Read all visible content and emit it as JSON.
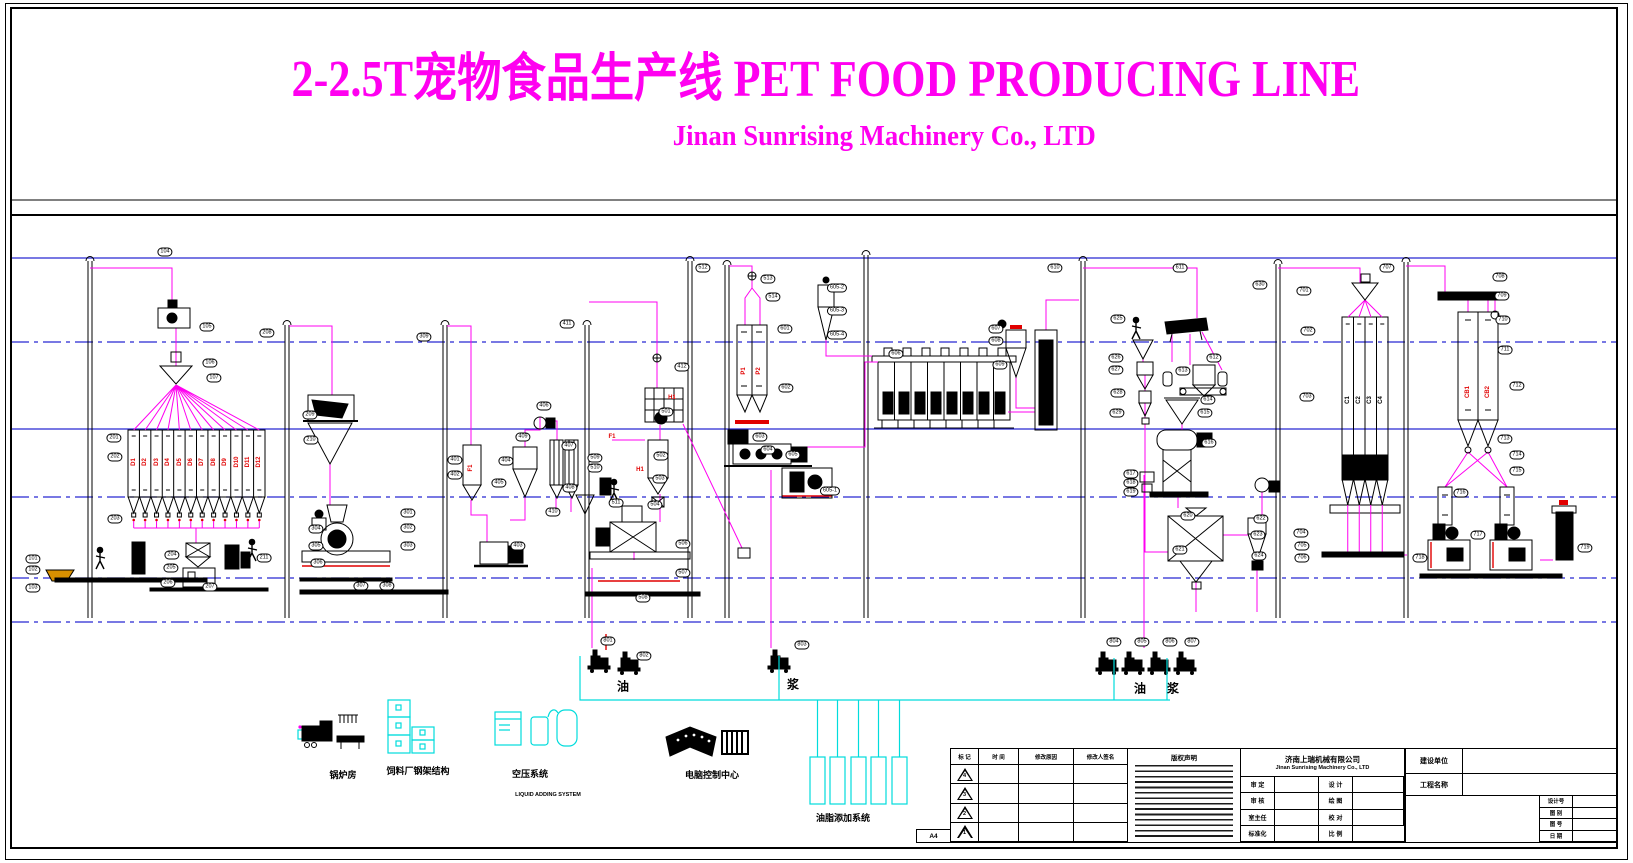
{
  "header": {
    "title": "2-2.5T宠物食品生产线 PET FOOD PRODUCING LINE",
    "subtitle": "Jinan Sunrising Machinery Co., LTD"
  },
  "colors": {
    "magenta": "#FF00F0",
    "blue": "#2828D2",
    "cyan": "#00DCDC",
    "red": "#E10000",
    "black": "#000000"
  },
  "tags": [
    [
      "101",
      33,
      559
    ],
    [
      "102",
      33,
      570
    ],
    [
      "103",
      33,
      588
    ],
    [
      "104",
      165,
      252
    ],
    [
      "105",
      207,
      327
    ],
    [
      "106",
      210,
      363
    ],
    [
      "107",
      214,
      378
    ],
    [
      "201",
      114,
      438
    ],
    [
      "202",
      115,
      457
    ],
    [
      "203",
      115,
      519
    ],
    [
      "204",
      172,
      555
    ],
    [
      "205",
      171,
      568
    ],
    [
      "206",
      168,
      583
    ],
    [
      "207",
      210,
      587
    ],
    [
      "208",
      267,
      333
    ],
    [
      "209",
      310,
      415
    ],
    [
      "210",
      311,
      440
    ],
    [
      "211",
      264,
      558
    ],
    [
      "301",
      408,
      513
    ],
    [
      "302",
      408,
      528
    ],
    [
      "303",
      408,
      546
    ],
    [
      "304",
      316,
      529
    ],
    [
      "305",
      316,
      546
    ],
    [
      "306",
      318,
      563
    ],
    [
      "307",
      361,
      586
    ],
    [
      "308",
      387,
      586
    ],
    [
      "309",
      424,
      337
    ],
    [
      "401",
      455,
      460
    ],
    [
      "402",
      455,
      475
    ],
    [
      "403",
      518,
      546
    ],
    [
      "404",
      506,
      461
    ],
    [
      "405",
      499,
      483
    ],
    [
      "406",
      544,
      406
    ],
    [
      "407",
      569,
      446
    ],
    [
      "408",
      570,
      488
    ],
    [
      "409",
      523,
      437
    ],
    [
      "410",
      553,
      512
    ],
    [
      "411",
      567,
      324
    ],
    [
      "412",
      682,
      367
    ],
    [
      "501",
      666,
      412
    ],
    [
      "502",
      661,
      456
    ],
    [
      "503",
      660,
      479
    ],
    [
      "504",
      655,
      505
    ],
    [
      "506",
      683,
      544
    ],
    [
      "507",
      683,
      573
    ],
    [
      "508",
      643,
      598
    ],
    [
      "509",
      595,
      458
    ],
    [
      "510",
      595,
      468
    ],
    [
      "511",
      616,
      503
    ],
    [
      "512",
      703,
      268
    ],
    [
      "513",
      768,
      279
    ],
    [
      "514",
      773,
      297
    ],
    [
      "601",
      785,
      329
    ],
    [
      "602",
      786,
      388
    ],
    [
      "603",
      760,
      437
    ],
    [
      "604",
      768,
      450
    ],
    [
      "605",
      793,
      455
    ],
    [
      "605-1",
      830,
      491
    ],
    [
      "605-2",
      837,
      288
    ],
    [
      "605-3",
      837,
      311
    ],
    [
      "605-4",
      837,
      335
    ],
    [
      "606",
      896,
      354
    ],
    [
      "607",
      996,
      329
    ],
    [
      "608",
      996,
      341
    ],
    [
      "609",
      1000,
      365
    ],
    [
      "610",
      1055,
      268
    ],
    [
      "611",
      1180,
      268
    ],
    [
      "612",
      1214,
      358
    ],
    [
      "613",
      1183,
      371
    ],
    [
      "614",
      1208,
      400
    ],
    [
      "615",
      1205,
      413
    ],
    [
      "616",
      1209,
      443
    ],
    [
      "617",
      1131,
      474
    ],
    [
      "618",
      1131,
      483
    ],
    [
      "619",
      1131,
      492
    ],
    [
      "620",
      1188,
      516
    ],
    [
      "621",
      1180,
      550
    ],
    [
      "622",
      1261,
      519
    ],
    [
      "623",
      1258,
      535
    ],
    [
      "624",
      1259,
      556
    ],
    [
      "625",
      1118,
      319
    ],
    [
      "626",
      1116,
      358
    ],
    [
      "627",
      1116,
      370
    ],
    [
      "628",
      1118,
      393
    ],
    [
      "629",
      1117,
      413
    ],
    [
      "630",
      1260,
      285
    ],
    [
      "701",
      1304,
      291
    ],
    [
      "702",
      1308,
      331
    ],
    [
      "703",
      1307,
      397
    ],
    [
      "704",
      1301,
      533
    ],
    [
      "705",
      1302,
      546
    ],
    [
      "706",
      1302,
      558
    ],
    [
      "707",
      1387,
      268
    ],
    [
      "708",
      1500,
      277
    ],
    [
      "709",
      1502,
      296
    ],
    [
      "710",
      1503,
      320
    ],
    [
      "711",
      1505,
      350
    ],
    [
      "712",
      1517,
      386
    ],
    [
      "713",
      1505,
      439
    ],
    [
      "714",
      1517,
      455
    ],
    [
      "715",
      1517,
      471
    ],
    [
      "716",
      1461,
      493
    ],
    [
      "717",
      1478,
      535
    ],
    [
      "718",
      1420,
      558
    ],
    [
      "719",
      1585,
      548
    ],
    [
      "801",
      608,
      641
    ],
    [
      "802",
      644,
      656
    ],
    [
      "803",
      802,
      645
    ],
    [
      "804",
      1114,
      642
    ],
    [
      "805",
      1142,
      642
    ],
    [
      "806",
      1170,
      642
    ],
    [
      "807",
      1192,
      642
    ]
  ],
  "red_labels": [
    [
      "D1",
      134,
      462,
      1
    ],
    [
      "D2",
      145,
      462,
      1
    ],
    [
      "D3",
      157,
      462,
      1
    ],
    [
      "D4",
      168,
      462,
      1
    ],
    [
      "D5",
      180,
      462,
      1
    ],
    [
      "D6",
      191,
      462,
      1
    ],
    [
      "D7",
      202,
      462,
      1
    ],
    [
      "D8",
      214,
      462,
      1
    ],
    [
      "D9",
      225,
      462,
      1
    ],
    [
      "D10",
      237,
      462,
      1
    ],
    [
      "D11",
      248,
      462,
      1
    ],
    [
      "D12",
      259,
      462,
      1
    ],
    [
      "F1",
      471,
      468,
      1
    ],
    [
      "F1",
      612,
      437,
      0
    ],
    [
      "H1",
      672,
      398,
      0
    ],
    [
      "H1",
      640,
      470,
      0
    ],
    [
      "P1",
      744,
      371,
      1
    ],
    [
      "P2",
      759,
      371,
      1
    ],
    [
      "CB1",
      1468,
      392,
      1
    ],
    [
      "CB2",
      1488,
      392,
      1
    ]
  ],
  "black_labels": [
    [
      "C1",
      1348,
      400,
      1
    ],
    [
      "C2",
      1359,
      400,
      1
    ],
    [
      "C3",
      1370,
      400,
      1
    ],
    [
      "C4",
      1381,
      400,
      1
    ]
  ],
  "flow_labels": [
    [
      "油",
      623,
      686
    ],
    [
      "浆",
      793,
      684
    ],
    [
      "油",
      1140,
      688
    ],
    [
      "浆",
      1173,
      688
    ]
  ],
  "legend": {
    "boiler": "锅炉房",
    "steel": "饲料厂钢架结构",
    "air": "空压系统",
    "air_en": "LIQUID ADDING SYSTEM",
    "control": "电脑控制中心",
    "oil": "油脂添加系统"
  },
  "titleblock": {
    "rev_headers": [
      "标 记",
      "时 间",
      "修改原因",
      "修改人签名"
    ],
    "revisions": [
      "4",
      "3",
      "2",
      "1"
    ],
    "sheet": "A4",
    "notice_title": "版权声明",
    "company_cn": "济南上瑞机械有限公司",
    "company_en": "Jinan Sunrising Machinery Co., LTD",
    "sign_rows": [
      [
        "审 定",
        "设 计"
      ],
      [
        "审 核",
        "绘 图"
      ],
      [
        "室主任",
        "校 对"
      ],
      [
        "标准化",
        "比 例"
      ]
    ],
    "owner_label": "建设单位",
    "project_label": "工程名称",
    "right_rows": [
      "设计号",
      "图 别",
      "图 号",
      "日 期"
    ]
  }
}
